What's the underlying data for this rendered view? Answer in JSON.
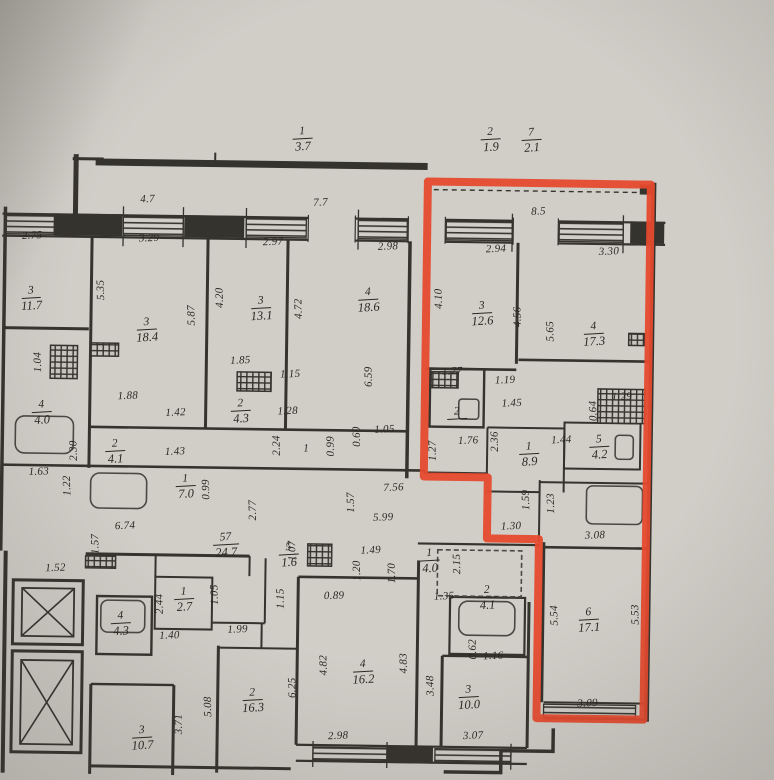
{
  "plan": {
    "type": "apartment-building-floor-plan",
    "highlight_outline_color": "#e64a2e",
    "paper_color": "#d1cec8",
    "ink_color": "#35332d"
  },
  "plan_labels": {
    "rooms": [
      {
        "num": "1",
        "area": "3.7",
        "x": 299,
        "y": 140
      },
      {
        "num": "2",
        "area": "1.9",
        "x": 487,
        "y": 138
      },
      {
        "num": "7",
        "area": "2.1",
        "x": 528,
        "y": 138
      },
      {
        "num": "3",
        "area": "11.7",
        "x": 30,
        "y": 303
      },
      {
        "num": "3",
        "area": "18.4",
        "x": 146,
        "y": 333
      },
      {
        "num": "3",
        "area": "13.1",
        "x": 260,
        "y": 310
      },
      {
        "num": "4",
        "area": "18.6",
        "x": 367,
        "y": 300
      },
      {
        "num": "3",
        "area": "12.6",
        "x": 481,
        "y": 312
      },
      {
        "num": "4",
        "area": "17.3",
        "x": 593,
        "y": 331
      },
      {
        "num": "4",
        "area": "4.0",
        "x": 42,
        "y": 417
      },
      {
        "num": "2",
        "area": "4.1",
        "x": 116,
        "y": 455
      },
      {
        "num": "2",
        "area": "4.3",
        "x": 241,
        "y": 413
      },
      {
        "num": "2",
        "area": "",
        "x": 457,
        "y": 411
      },
      {
        "num": "1",
        "area": "8.9",
        "x": 530,
        "y": 452
      },
      {
        "num": "5",
        "area": "4.2",
        "x": 600,
        "y": 444
      },
      {
        "num": "1",
        "area": "7.0",
        "x": 187,
        "y": 489
      },
      {
        "num": "57",
        "area": "24.7",
        "x": 228,
        "y": 547
      },
      {
        "num": "5",
        "area": "1.6",
        "x": 291,
        "y": 556
      },
      {
        "num": "1",
        "area": "4.0",
        "x": 432,
        "y": 560
      },
      {
        "num": "2",
        "area": "4.1",
        "x": 490,
        "y": 596
      },
      {
        "num": "4",
        "area": "4.3",
        "x": 124,
        "y": 627
      },
      {
        "num": "1",
        "area": "2.7",
        "x": 187,
        "y": 602
      },
      {
        "num": "6",
        "area": "17.1",
        "x": 592,
        "y": 617
      },
      {
        "num": "4",
        "area": "16.2",
        "x": 367,
        "y": 672
      },
      {
        "num": "3",
        "area": "10.0",
        "x": 473,
        "y": 696
      },
      {
        "num": "2",
        "area": "16.3",
        "x": 257,
        "y": 702
      },
      {
        "num": "3",
        "area": "10.7",
        "x": 147,
        "y": 741
      }
    ],
    "dimensions": [
      {
        "t": "4.7",
        "x": 145,
        "y": 203
      },
      {
        "t": "7.7",
        "x": 318,
        "y": 204
      },
      {
        "t": "8.5",
        "x": 536,
        "y": 210
      },
      {
        "t": "2.75",
        "x": 30,
        "y": 241
      },
      {
        "t": "3.29",
        "x": 147,
        "y": 242
      },
      {
        "t": "2.97",
        "x": 271,
        "y": 244
      },
      {
        "t": "2.98",
        "x": 386,
        "y": 247
      },
      {
        "t": "2.94",
        "x": 494,
        "y": 248
      },
      {
        "t": "3.30",
        "x": 607,
        "y": 249
      },
      {
        "t": "5.35",
        "x": 100,
        "y": 294,
        "r": 1
      },
      {
        "t": "5.87",
        "x": 191,
        "y": 318,
        "r": 1
      },
      {
        "t": "4.20",
        "x": 219,
        "y": 300,
        "r": 1
      },
      {
        "t": "4.72",
        "x": 298,
        "y": 310,
        "r": 1
      },
      {
        "t": "6.59",
        "x": 369,
        "y": 377,
        "r": 1
      },
      {
        "t": "4.10",
        "x": 438,
        "y": 298,
        "r": 1
      },
      {
        "t": "4.56",
        "x": 517,
        "y": 315,
        "r": 1
      },
      {
        "t": "5.65",
        "x": 550,
        "y": 329,
        "r": 1
      },
      {
        "t": "1.04",
        "x": 38,
        "y": 367,
        "r": 1
      },
      {
        "t": "1.88",
        "x": 128,
        "y": 400
      },
      {
        "t": "1.42",
        "x": 176,
        "y": 416
      },
      {
        "t": "1.43",
        "x": 176,
        "y": 455
      },
      {
        "t": "2.30",
        "x": 75,
        "y": 455,
        "r": 1
      },
      {
        "t": "1.63",
        "x": 40,
        "y": 477
      },
      {
        "t": "1.22",
        "x": 69,
        "y": 490,
        "r": 1
      },
      {
        "t": "0.99",
        "x": 208,
        "y": 492,
        "r": 1
      },
      {
        "t": "6.74",
        "x": 127,
        "y": 530
      },
      {
        "t": "1.57",
        "x": 98,
        "y": 548,
        "r": 1
      },
      {
        "t": "1.52",
        "x": 58,
        "y": 573
      },
      {
        "t": "1.85",
        "x": 240,
        "y": 363
      },
      {
        "t": "1.15",
        "x": 290,
        "y": 376
      },
      {
        "t": "1.28",
        "x": 288,
        "y": 413
      },
      {
        "t": "2.24",
        "x": 278,
        "y": 447,
        "r": 1
      },
      {
        "t": "1",
        "x": 307,
        "y": 450
      },
      {
        "t": "0.99",
        "x": 332,
        "y": 447,
        "r": 1
      },
      {
        "t": "0.60",
        "x": 358,
        "y": 437,
        "r": 1
      },
      {
        "t": "1.05",
        "x": 385,
        "y": 430
      },
      {
        "t": "7.56",
        "x": 395,
        "y": 488
      },
      {
        "t": "1.57",
        "x": 353,
        "y": 503,
        "r": 1
      },
      {
        "t": "5.99",
        "x": 385,
        "y": 518
      },
      {
        "t": "2.77",
        "x": 255,
        "y": 512,
        "r": 1
      },
      {
        "t": "1.07",
        "x": 295,
        "y": 552,
        "r": 1
      },
      {
        "t": "1.49",
        "x": 373,
        "y": 551
      },
      {
        "t": "1.20",
        "x": 360,
        "y": 571,
        "r": 1
      },
      {
        "t": "1.70",
        "x": 395,
        "y": 573,
        "r": 1
      },
      {
        "t": "0.89",
        "x": 337,
        "y": 597
      },
      {
        "t": "1.15",
        "x": 284,
        "y": 600,
        "r": 1
      },
      {
        "t": "6.25",
        "x": 297,
        "y": 689,
        "r": 1
      },
      {
        "t": "4.82",
        "x": 328,
        "y": 666,
        "r": 1
      },
      {
        "t": "4.83",
        "x": 408,
        "y": 663,
        "r": 1
      },
      {
        "t": "2.98",
        "x": 343,
        "y": 737
      },
      {
        "t": "3.48",
        "x": 435,
        "y": 685,
        "r": 1
      },
      {
        "t": "3.07",
        "x": 478,
        "y": 735
      },
      {
        "t": "0.62",
        "x": 477,
        "y": 648,
        "r": 1
      },
      {
        "t": "1.16",
        "x": 497,
        "y": 655
      },
      {
        "t": "1.35",
        "x": 447,
        "y": 596
      },
      {
        "t": "2.15",
        "x": 460,
        "y": 563,
        "r": 1
      },
      {
        "t": "2.44",
        "x": 163,
        "y": 607,
        "r": 1
      },
      {
        "t": "1.05",
        "x": 218,
        "y": 597,
        "r": 1
      },
      {
        "t": "1.40",
        "x": 173,
        "y": 639
      },
      {
        "t": "1.99",
        "x": 241,
        "y": 632
      },
      {
        "t": "3.71",
        "x": 184,
        "y": 727,
        "r": 1
      },
      {
        "t": "5.08",
        "x": 213,
        "y": 709,
        "r": 1
      },
      {
        "t": "1.77",
        "x": 452,
        "y": 371
      },
      {
        "t": "1.19",
        "x": 505,
        "y": 379
      },
      {
        "t": "1.45",
        "x": 512,
        "y": 402
      },
      {
        "t": "2.36",
        "x": 496,
        "y": 440,
        "r": 1
      },
      {
        "t": "1.76",
        "x": 469,
        "y": 440
      },
      {
        "t": "1.27",
        "x": 434,
        "y": 450,
        "r": 1
      },
      {
        "t": "1.44",
        "x": 562,
        "y": 438
      },
      {
        "t": "0.64",
        "x": 594,
        "y": 408,
        "r": 1
      },
      {
        "t": "1.29",
        "x": 622,
        "y": 394
      },
      {
        "t": "1.59",
        "x": 528,
        "y": 498,
        "r": 1
      },
      {
        "t": "1.23",
        "x": 553,
        "y": 501,
        "r": 1
      },
      {
        "t": "1.30",
        "x": 513,
        "y": 525
      },
      {
        "t": "3.08",
        "x": 597,
        "y": 533
      },
      {
        "t": "5.54",
        "x": 558,
        "y": 613,
        "r": 1
      },
      {
        "t": "5.53",
        "x": 639,
        "y": 611,
        "r": 1
      },
      {
        "t": "3.09",
        "x": 592,
        "y": 701
      }
    ]
  }
}
